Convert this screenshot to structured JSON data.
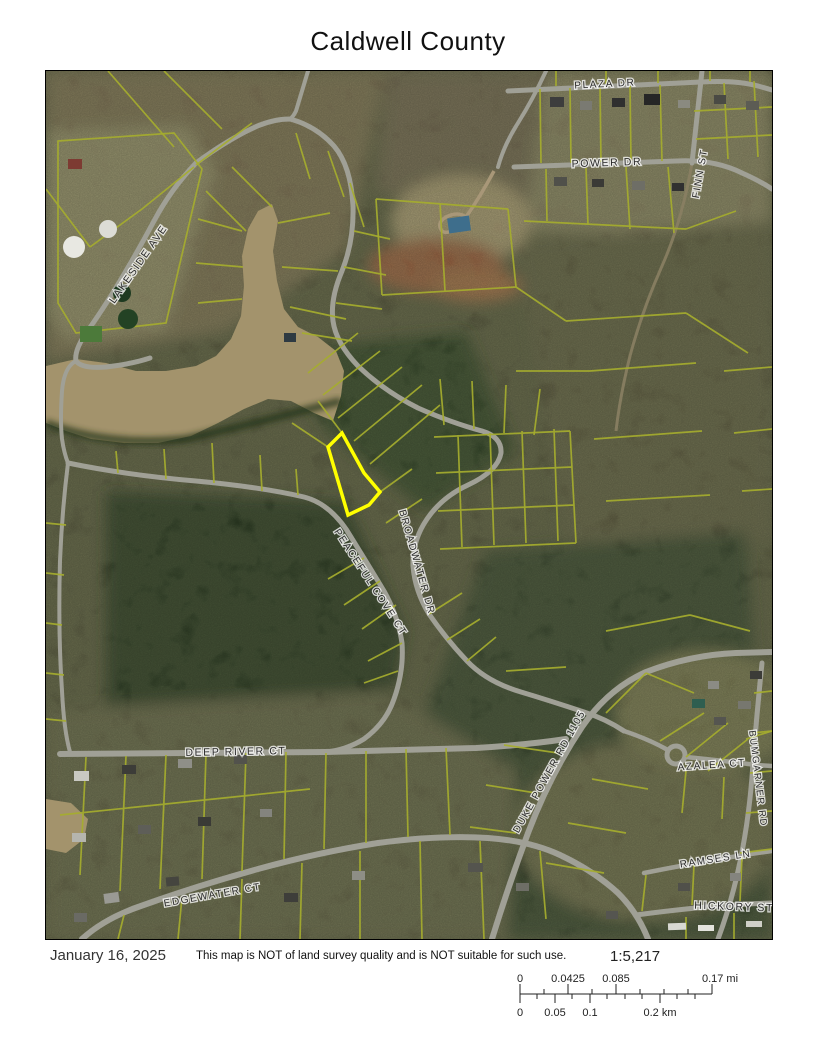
{
  "title": "Caldwell County",
  "map": {
    "highlight_color": "#ffff00",
    "parcel_line_color": "#a5ad2e",
    "road_color": "#a0a096",
    "water_color": "#a3936c",
    "forest_color": "#2c3a26",
    "street_labels": [
      {
        "text": "PLAZA DR",
        "x": 559,
        "y": 16,
        "rot": -3,
        "size": 10
      },
      {
        "text": "POWER DR",
        "x": 561,
        "y": 95,
        "rot": -2,
        "size": 10.5
      },
      {
        "text": "FINN ST",
        "x": 657,
        "y": 103,
        "rot": -80,
        "size": 10
      },
      {
        "text": "LAKESIDE AVE",
        "x": 95,
        "y": 195,
        "rot": -55,
        "size": 10.5
      },
      {
        "text": "BROADWATER DR",
        "x": 368,
        "y": 492,
        "rot": 74,
        "size": 10
      },
      {
        "text": "PEACEFUL COVE CT",
        "x": 322,
        "y": 513,
        "rot": 57,
        "size": 10
      },
      {
        "text": "DEEP RIVER CT",
        "x": 190,
        "y": 684,
        "rot": -1,
        "size": 10.5
      },
      {
        "text": "EDGEWATER CT",
        "x": 167,
        "y": 827,
        "rot": -10,
        "size": 10
      },
      {
        "text": "DUKE POWER RD 1105",
        "x": 506,
        "y": 702,
        "rot": -61,
        "size": 10
      },
      {
        "text": "AZALEA CT",
        "x": 666,
        "y": 697,
        "rot": -4,
        "size": 10
      },
      {
        "text": "BUMGARNER RD",
        "x": 709,
        "y": 708,
        "rot": 83,
        "size": 9.5
      },
      {
        "text": "RAMSES LN",
        "x": 670,
        "y": 791,
        "rot": -9,
        "size": 10
      },
      {
        "text": "HICKORY ST",
        "x": 688,
        "y": 839,
        "rot": 2,
        "size": 10.5
      }
    ]
  },
  "footer": {
    "date": "January 16, 2025",
    "disclaimer": "This map is NOT of land survey quality and is NOT suitable for such use.",
    "scale_ratio": "1:5,217",
    "scale_mi": [
      "0",
      "0.0425",
      "0.085",
      "0.17 mi"
    ],
    "scale_km": [
      "0",
      "0.05",
      "0.1",
      "0.2 km"
    ]
  }
}
